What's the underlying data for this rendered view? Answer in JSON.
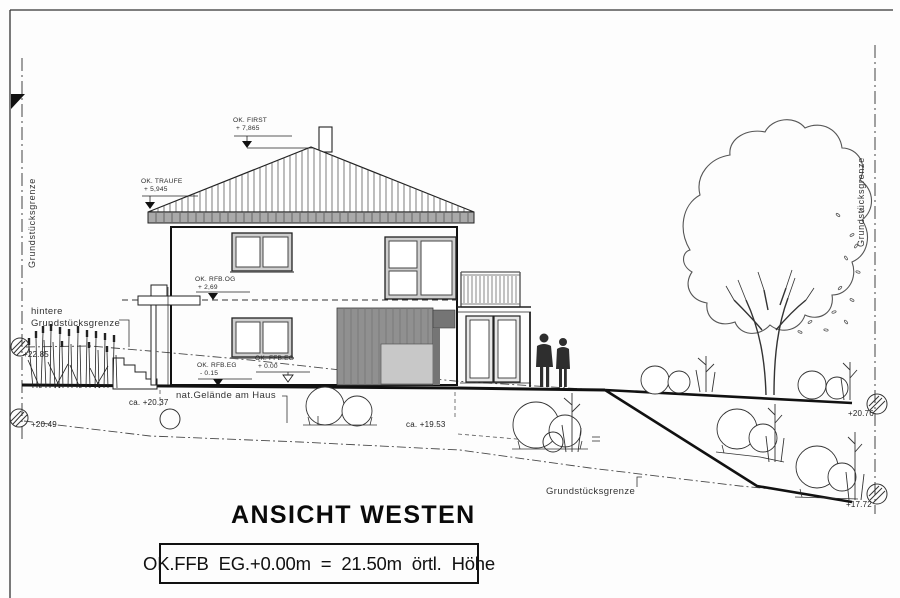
{
  "drawing": {
    "title": "ANSICHT WESTEN",
    "footer": "OK.FFB EG.+0.00m = 21.50m örtl. Höhe"
  },
  "boundaries": {
    "left": "Grundstücksgrenze",
    "right": "Grundstücksgrenze",
    "rear_line1": "hintere",
    "rear_line2": "Grundstücksgrenze",
    "south": "Grundstücksgrenze"
  },
  "levels": {
    "first_name": "OK. FIRST",
    "first_value": "+ 7,865",
    "traufe_name": "OK. TRAUFE",
    "traufe_value": "+ 5,945",
    "rfb_og_name": "OK. RFB.OG",
    "rfb_og_value": "+ 2,69",
    "rfb_eg_name": "OK. RFB.EG",
    "rfb_eg_value": "- 0.15",
    "ffb_eg_name": "OK. FFB.EG",
    "ffb_eg_value": "+ 0.00"
  },
  "spots": {
    "rear": "+22.85",
    "left_lower": "+20.49",
    "house_left": "ca. +20.37",
    "house_right": "ca. +19.53",
    "right_upper": "+20.76",
    "right_lower": "+17.72"
  },
  "notes": {
    "nat_gelaende": "nat.Gelände am Haus"
  },
  "colors": {
    "line": "#1b1b1b",
    "panel_gray": "#909090",
    "opening_gray": "#c8c8c8",
    "fascia_gray": "#a9a9a9"
  }
}
